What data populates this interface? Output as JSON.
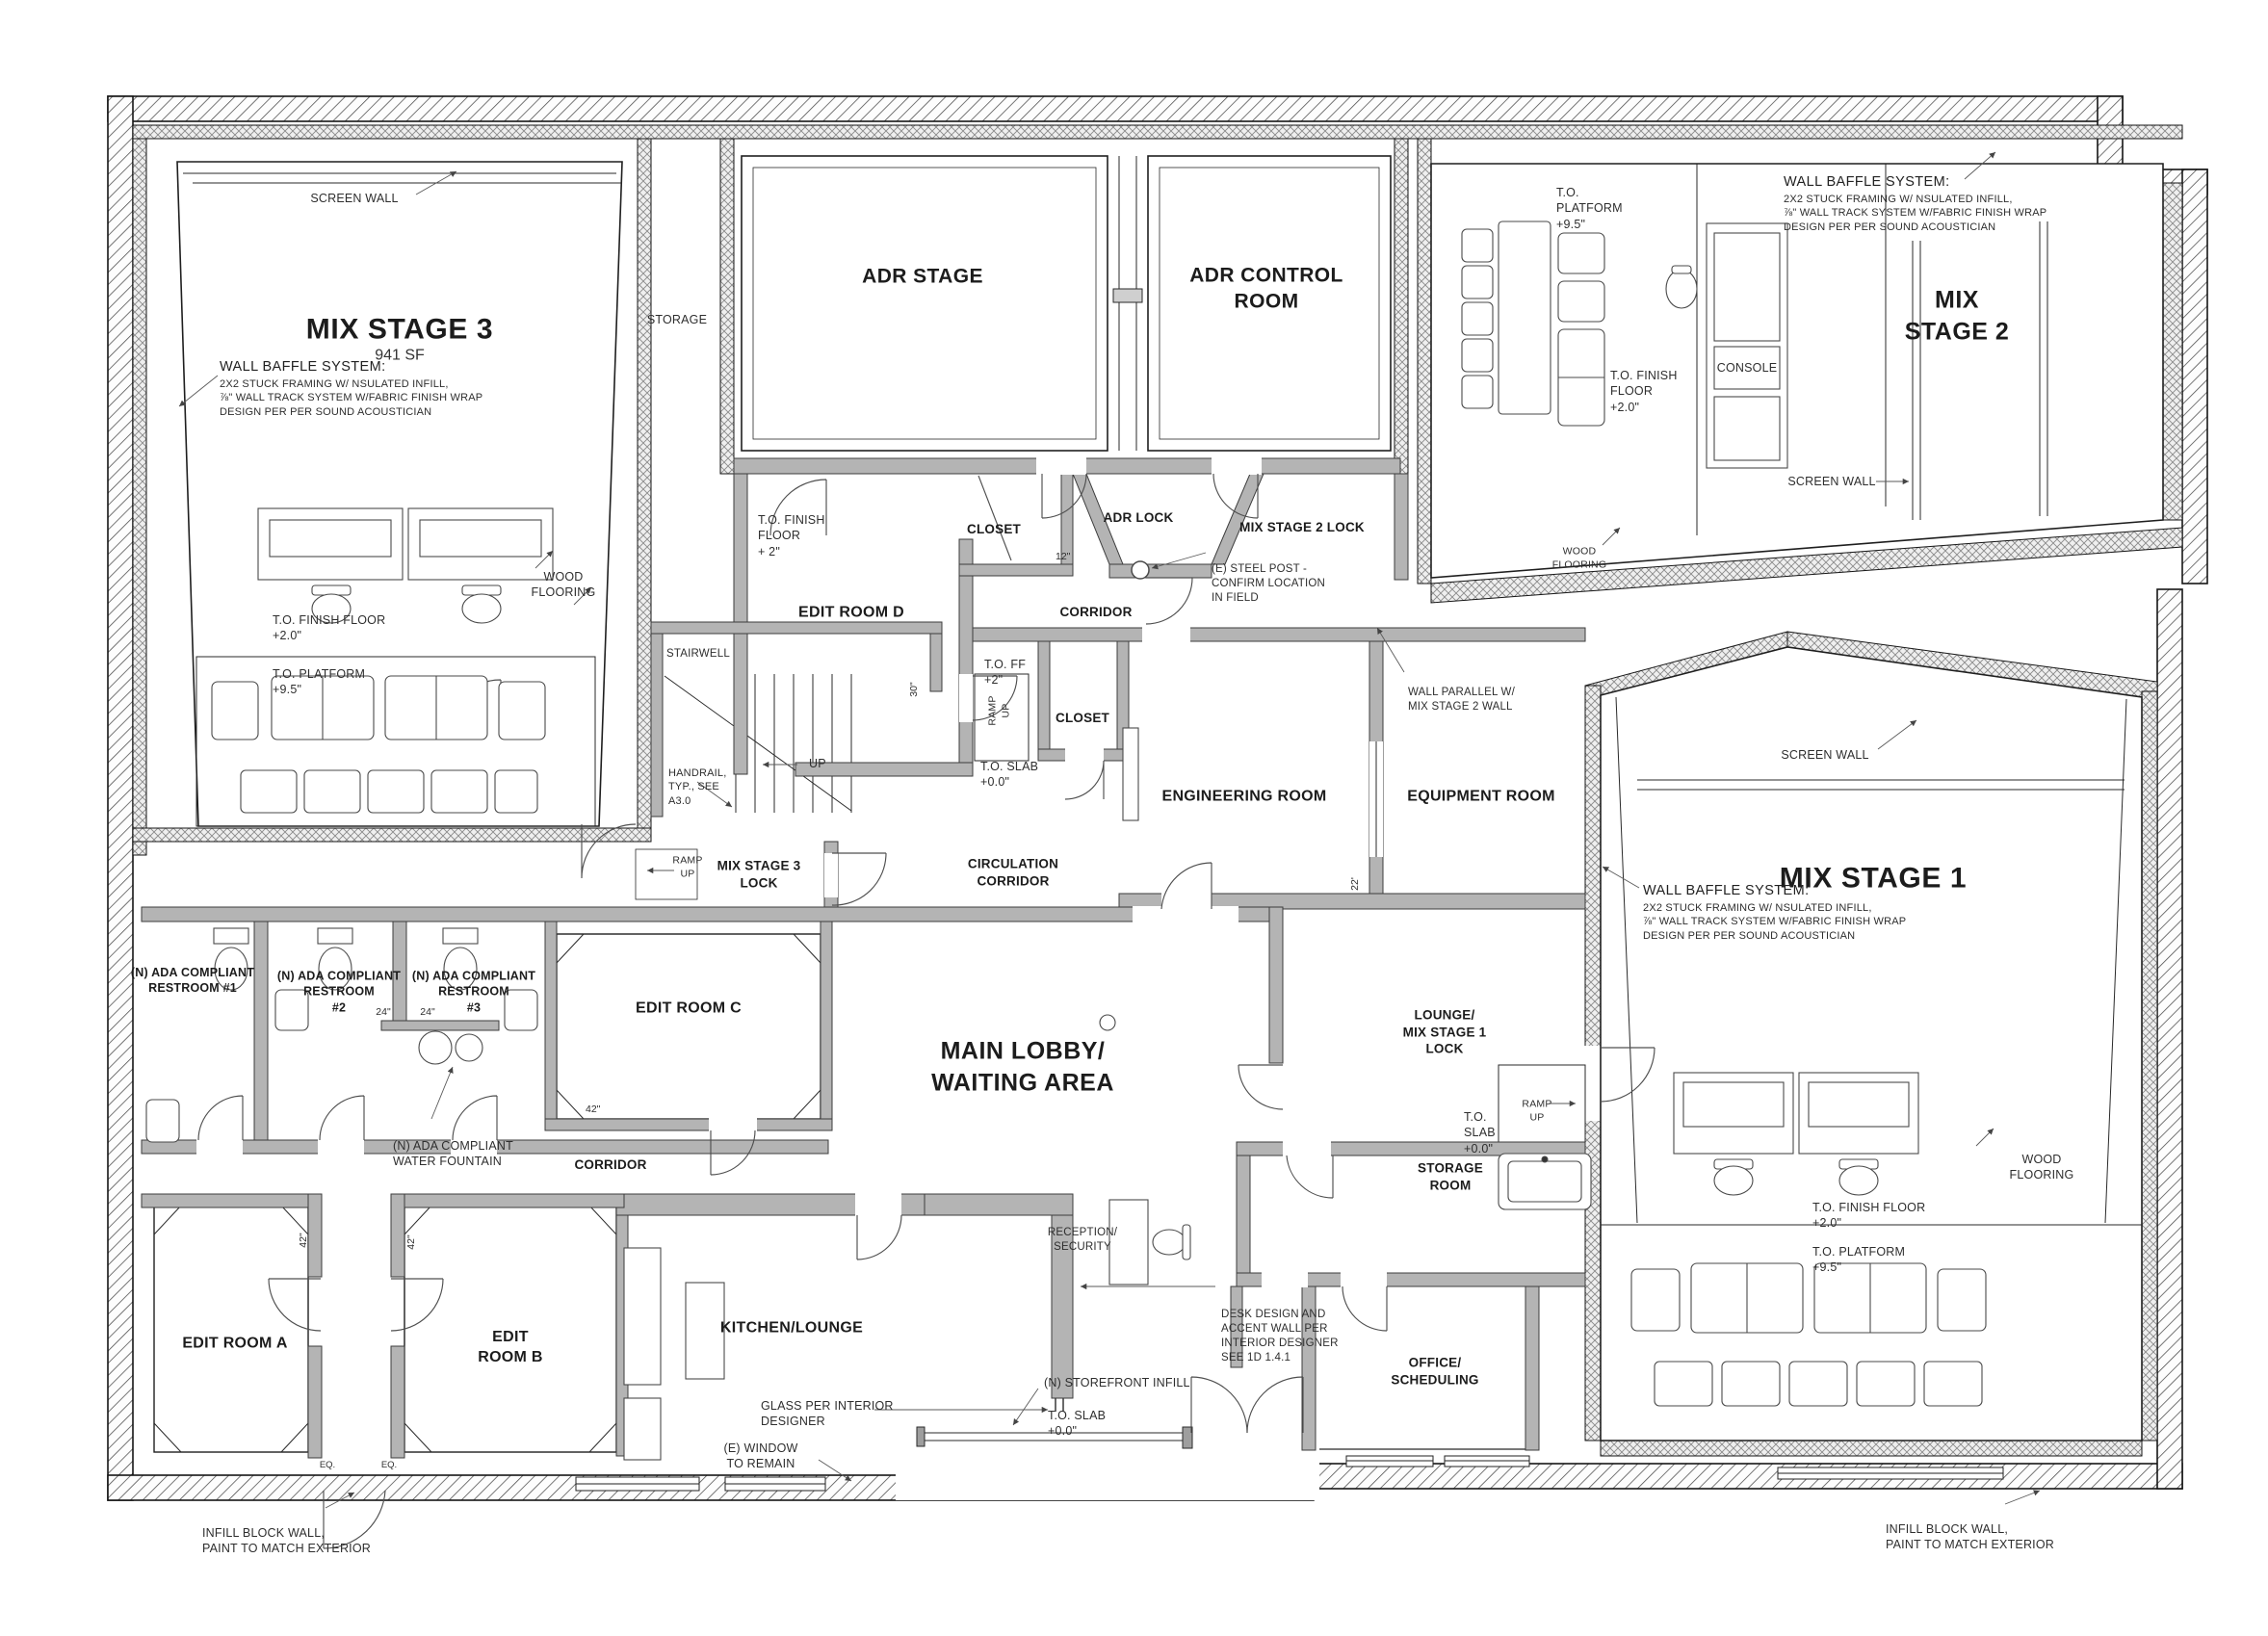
{
  "drawing": {
    "rooms": {
      "mix_stage_3": {
        "name": "MIX STAGE 3",
        "area": "941 SF"
      },
      "storage_chase": {
        "name": "STORAGE"
      },
      "adr_stage": {
        "name": "ADR STAGE"
      },
      "adr_control_room": {
        "name": "ADR CONTROL\nROOM"
      },
      "mix_stage_2": {
        "name": "MIX\nSTAGE 2"
      },
      "edit_room_d": {
        "name": "EDIT ROOM D"
      },
      "closet_north": {
        "name": "CLOSET"
      },
      "adr_lock": {
        "name": "ADR LOCK"
      },
      "mix_stage_2_lock": {
        "name": "MIX STAGE 2 LOCK"
      },
      "corridor_north": {
        "name": "CORRIDOR"
      },
      "stairwell": {
        "name": "STAIRWELL"
      },
      "closet_mid": {
        "name": "CLOSET"
      },
      "engineering_room": {
        "name": "ENGINEERING ROOM"
      },
      "equipment_room": {
        "name": "EQUIPMENT ROOM"
      },
      "mix_stage_3_lock": {
        "name": "MIX STAGE 3\nLOCK"
      },
      "circulation_corridor": {
        "name": "CIRCULATION\nCORRIDOR"
      },
      "restroom_1": {
        "name": "(N) ADA COMPLIANT\nRESTROOM #1"
      },
      "restroom_2": {
        "name": "(N) ADA COMPLIANT\nRESTROOM\n#2"
      },
      "restroom_3": {
        "name": "(N) ADA COMPLIANT\nRESTROOM\n#3"
      },
      "edit_room_c": {
        "name": "EDIT ROOM C"
      },
      "corridor_south": {
        "name": "CORRIDOR"
      },
      "main_lobby": {
        "name": "MAIN LOBBY/\nWAITING AREA"
      },
      "lounge_mix_stage_1_lock": {
        "name": "LOUNGE/\nMIX STAGE 1\nLOCK"
      },
      "storage_room": {
        "name": "STORAGE\nROOM"
      },
      "reception_security": {
        "name": "RECEPTION/\nSECURITY"
      },
      "edit_room_a": {
        "name": "EDIT ROOM A"
      },
      "edit_room_b": {
        "name": "EDIT\nROOM B"
      },
      "kitchen_lounge": {
        "name": "KITCHEN/LOUNGE"
      },
      "office_scheduling": {
        "name": "OFFICE/\nSCHEDULING"
      },
      "mix_stage_1": {
        "name": "MIX STAGE 1"
      }
    },
    "annotations": {
      "screen_wall": "SCREEN WALL",
      "wall_baffle_title": "WALL BAFFLE SYSTEM:",
      "wall_baffle_body": "2X2 STUCK FRAMING W/ NSULATED INFILL,\n⅞\" WALL TRACK SYSTEM W/FABRIC FINISH WRAP\nDESIGN PER PER SOUND ACOUSTICIAN",
      "wood_flooring": "WOOD\nFLOORING",
      "console": "CONSOLE",
      "steel_post": "(E) STEEL POST -\nCONFIRM LOCATION\nIN FIELD",
      "wall_parallel": "WALL PARALLEL W/\nMIX STAGE 2 WALL",
      "handrail": "HANDRAIL,\nTYP., SEE\nA3.0",
      "up": "UP",
      "ramp_up": "RAMP\nUP",
      "water_fountain": "(N) ADA COMPLIANT\nWATER FOUNTAIN",
      "desk_design": "DESK DESIGN AND\nACCENT WALL PER\nINTERIOR DESIGNER\nSEE 1D 1.4.1",
      "glass_interior": "GLASS PER INTERIOR\nDESIGNER",
      "window_remain": "(E) WINDOW\nTO REMAIN",
      "storefront_infill": "(N) STOREFRONT INFILL",
      "infill_block_wall": "INFILL BLOCK WALL,\nPAINT TO MATCH EXTERIOR"
    },
    "levels": {
      "finish_floor_20": "T.O. FINISH FLOOR\n+2.0\"",
      "finish_floor_20_stacked": "T.O. FINISH\nFLOOR\n+2.0\"",
      "finish_floor_2": "T.O. FINISH\nFLOOR\n+ 2\"",
      "ff_2": "T.O. FF\n+2\"",
      "platform_95": "T.O. PLATFORM\n+9.5\"",
      "platform_95_stacked": "T.O.\nPLATFORM\n+9.5\"",
      "slab_00": "T.O. SLAB\n+0.0\"",
      "slab_00_stacked": "T.O.\nSLAB\n+0.0\""
    },
    "dimensions": {
      "d24": "24\"",
      "d42": "42\"",
      "d12": "12\"",
      "d30": "30\"",
      "d22": "22'",
      "eq": "EQ."
    }
  }
}
